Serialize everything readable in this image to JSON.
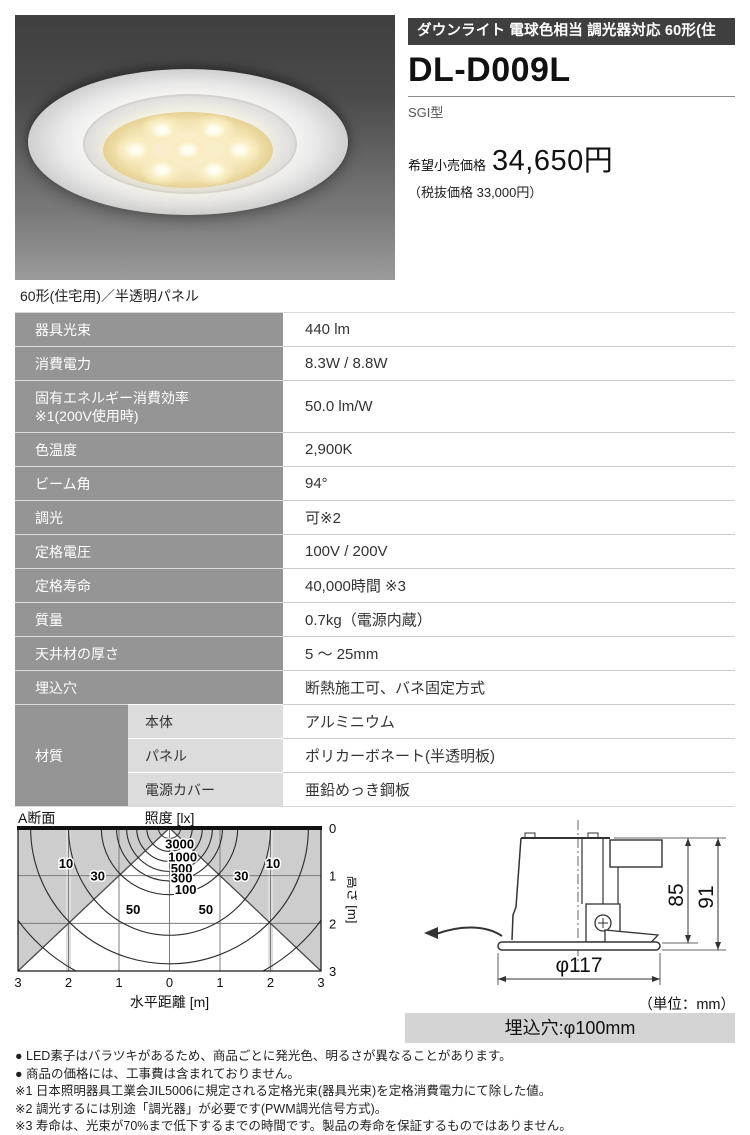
{
  "header": {
    "category_bar": "ダウンライト 電球色相当 調光器対応 60形(住宅用)",
    "model": "DL-D009L",
    "type_label": "SGI型",
    "price_label": "希望小売価格",
    "price_value": "34,650円",
    "price_tax_note": "（税抜価格 33,000円）"
  },
  "photo": {
    "caption": "60形(住宅用)／半透明パネル",
    "led_count": 7
  },
  "spec_table": {
    "rows": [
      {
        "label": "器具光束",
        "value": "440 lm"
      },
      {
        "label": "消費電力",
        "value": "8.3W / 8.8W"
      },
      {
        "label": [
          "固有エネルギー消費効率",
          "※1(200V使用時)"
        ],
        "value": "50.0 lm/W"
      },
      {
        "label": "色温度",
        "value": "2,900K"
      },
      {
        "label": "ビーム角",
        "value": "94°"
      },
      {
        "label": "調光",
        "value": "可※2"
      },
      {
        "label": "定格電圧",
        "value": "100V / 200V"
      },
      {
        "label": "定格寿命",
        "value": "40,000時間 ※3"
      },
      {
        "label": "質量",
        "value": "0.7kg（電源内蔵）"
      },
      {
        "label": "天井材の厚さ",
        "value": "5 ～ 25mm"
      },
      {
        "label": "埋込穴",
        "value": "断熱施工可、バネ固定方式"
      }
    ],
    "material_group": {
      "label": "材質",
      "rows": [
        {
          "sub": "本体",
          "value": "アルミニウム"
        },
        {
          "sub": "パネル",
          "value": "ポリカーボネート(半透明板)"
        },
        {
          "sub": "電源カバー",
          "value": "亜鉛めっき鋼板"
        }
      ]
    }
  },
  "chart_data": {
    "type": "line",
    "subtype": "isolux_contour_map",
    "section_label": "A断面",
    "title": "照度 [lx]",
    "xlabel": "水平距離 [m]",
    "ylabel": "高さ [m]",
    "xlim": [
      -3,
      3
    ],
    "ylim": [
      0,
      3
    ],
    "grid": true,
    "x_ticks": [
      {
        "m": -3,
        "label": "3"
      },
      {
        "m": -2,
        "label": "2"
      },
      {
        "m": -1,
        "label": "1"
      },
      {
        "m": 0,
        "label": "0"
      },
      {
        "m": 1,
        "label": "1"
      },
      {
        "m": 2,
        "label": "2"
      },
      {
        "m": 3,
        "label": "3"
      }
    ],
    "y_ticks": [
      {
        "m": 0,
        "label": "0"
      },
      {
        "m": 1,
        "label": "1"
      },
      {
        "m": 2,
        "label": "2"
      },
      {
        "m": 3,
        "label": "3"
      }
    ],
    "beam_lines": [
      {
        "from": [
          0,
          0
        ],
        "to": [
          -3,
          3
        ]
      },
      {
        "from": [
          0,
          0
        ],
        "to": [
          3,
          3
        ]
      }
    ],
    "contours": [
      {
        "lx": 3000,
        "rx_m": 0.45,
        "ry_m": 0.49
      },
      {
        "lx": 1000,
        "rx_m": 0.65,
        "ry_m": 0.7
      },
      {
        "lx": 500,
        "rx_m": 0.85,
        "ry_m": 0.91
      },
      {
        "lx": 300,
        "rx_m": 1.05,
        "ry_m": 1.11
      },
      {
        "lx": 100,
        "rx_m": 1.35,
        "ry_m": 1.4
      },
      {
        "lx": 50,
        "rx_m": 2.0,
        "ry_m": 2.25
      },
      {
        "lx": 30,
        "rx_m": 2.75,
        "ry_m": 2.85
      },
      {
        "lx": 10,
        "rx_m": 3.6,
        "ry_m": 3.5
      }
    ],
    "contour_labels": [
      {
        "text": "3000",
        "x_m": 0.2,
        "y_m": 0.35
      },
      {
        "text": "1000",
        "x_m": 0.26,
        "y_m": 0.62
      },
      {
        "text": "500",
        "x_m": 0.24,
        "y_m": 0.86
      },
      {
        "text": "300",
        "x_m": 0.24,
        "y_m": 1.06
      },
      {
        "text": "100",
        "x_m": 0.32,
        "y_m": 1.3
      },
      {
        "text": "50",
        "x_m": -0.72,
        "y_m": 1.72
      },
      {
        "text": "50",
        "x_m": 0.72,
        "y_m": 1.72
      },
      {
        "text": "30",
        "x_m": -1.42,
        "y_m": 1.02
      },
      {
        "text": "30",
        "x_m": 1.42,
        "y_m": 1.02
      },
      {
        "text": "10",
        "x_m": -2.05,
        "y_m": 0.76
      },
      {
        "text": "10",
        "x_m": 2.05,
        "y_m": 0.76
      }
    ],
    "shading": "outside_beam_gray"
  },
  "drawing": {
    "dim_depth": "85",
    "dim_height": "91",
    "dim_diameter": "φ117",
    "unit_note": "（単位：mm）",
    "hole_label": "埋込穴:φ100mm"
  },
  "footer": {
    "notes": [
      "● LED素子はバラツキがあるため、商品ごとに発光色、明るさが異なることがあります。",
      "● 商品の価格には、工事費は含まれておりません。",
      "※1 日本照明器具工業会JIL5006に規定される定格光束(器具光束)を定格消費電力にて除した値。",
      "※2 調光するには別途「調光器」が必要です(PWM調光信号方式)。",
      "※3 寿命は、光束が70%まで低下するまでの時間です。製品の寿命を保証するものではありません。"
    ]
  },
  "colors": {
    "category_bar_bg": "#3f3f3f",
    "table_label_bg": "#959595",
    "table_sublabel_bg": "#dcdcdc",
    "hole_bar_bg": "#d4d4d4",
    "chart_shading": "#cdcdcd",
    "led_warm": "#f9edc2"
  }
}
